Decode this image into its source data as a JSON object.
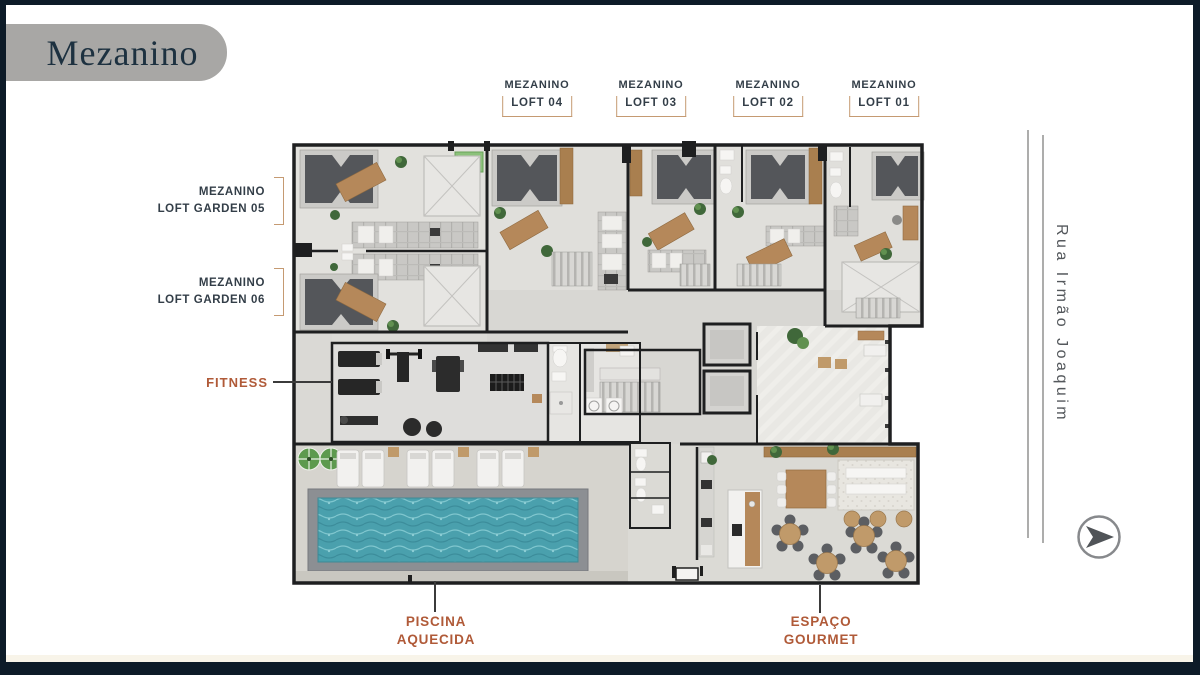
{
  "badge": {
    "title": "Mezanino"
  },
  "street": {
    "name": "Rua Irmão Joaquim"
  },
  "callouts": {
    "top": [
      {
        "line1": "MEZANINO",
        "line2": "LOFT 04"
      },
      {
        "line1": "MEZANINO",
        "line2": "LOFT 03"
      },
      {
        "line1": "MEZANINO",
        "line2": "LOFT 02"
      },
      {
        "line1": "MEZANINO",
        "line2": "LOFT 01"
      }
    ],
    "left": [
      {
        "line1": "MEZANINO",
        "line2": "LOFT GARDEN 05"
      },
      {
        "line1": "MEZANINO",
        "line2": "LOFT GARDEN 06"
      }
    ],
    "fitness": {
      "label": "FITNESS"
    },
    "pool": {
      "line1": "PISCINA",
      "line2": "AQUECIDA"
    },
    "gourmet": {
      "line1": "ESPAÇO",
      "line2": "GOURMET"
    }
  },
  "icons": {
    "direction_arrow": "➤"
  },
  "colors": {
    "frame_navy": "#0d1b28",
    "badge_gray": "#a8a7a5",
    "badge_text": "#1d3140",
    "label_dark": "#333e48",
    "accent_terracotta": "#b05a38",
    "bracket_tan": "#c59a72",
    "pool_water": "#4aa0ad",
    "street_text": "#54585c"
  }
}
